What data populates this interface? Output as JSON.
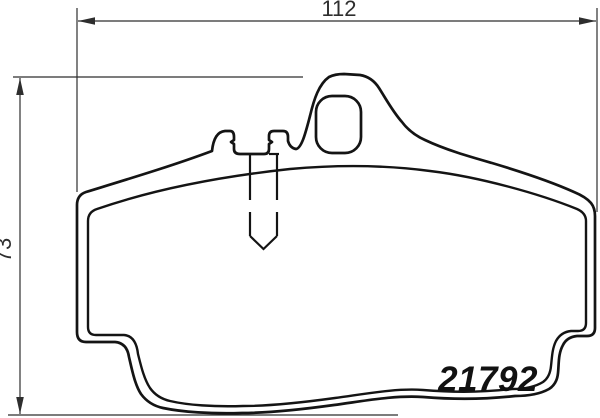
{
  "drawing": {
    "part_number": "21792",
    "dimensions": {
      "width": "112",
      "height": "73"
    },
    "colors": {
      "outline": "#141414",
      "dimension": "#2e2e2e",
      "background": "#ffffff"
    },
    "icons": {
      "shape": "brake-pad-outline"
    }
  }
}
